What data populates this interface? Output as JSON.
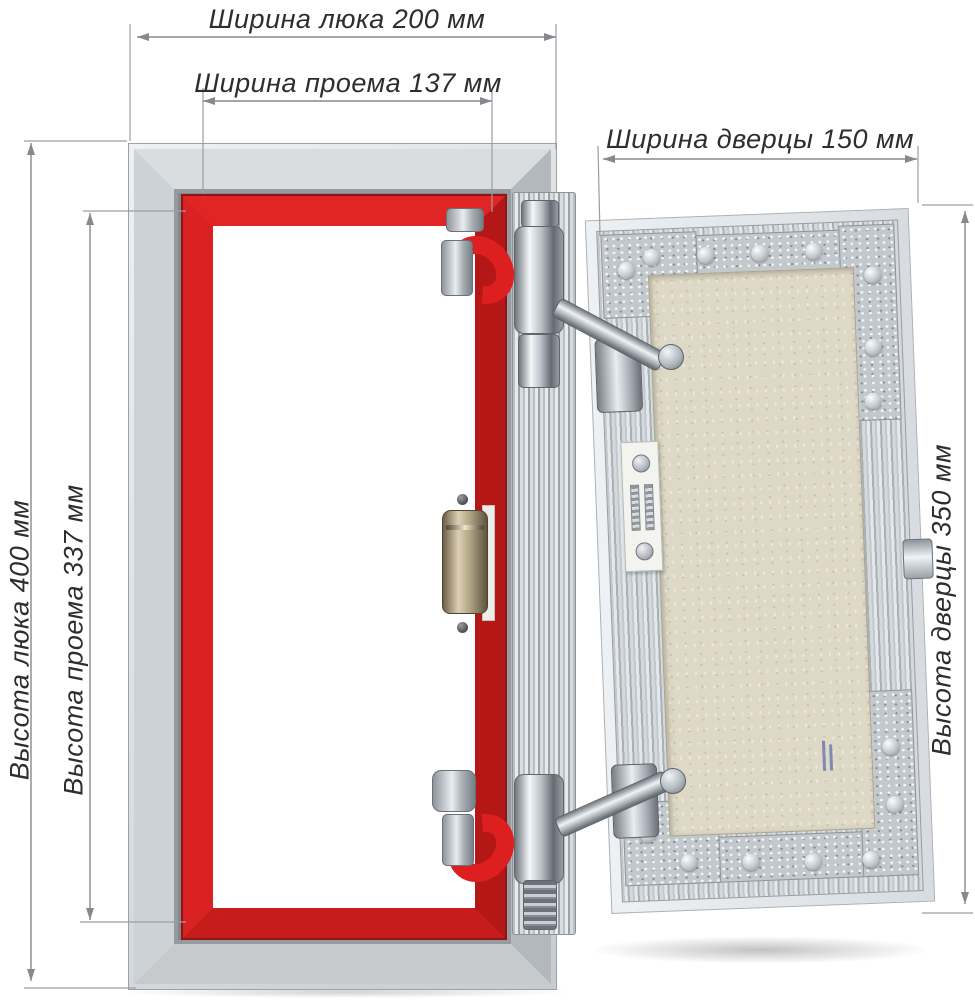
{
  "diagram": {
    "type": "access-hatch-dimension-diagram",
    "unit": "мм",
    "dimensions": {
      "hatch_width": {
        "label": "Ширина люка 200 мм",
        "value_mm": 200
      },
      "opening_width": {
        "label": "Ширина проема 137 мм",
        "value_mm": 137
      },
      "door_width": {
        "label": "Ширина дверцы 150 мм",
        "value_mm": 150
      },
      "hatch_height": {
        "label": "Высота люка 400 мм",
        "value_mm": 400
      },
      "opening_height": {
        "label": "Высота проема 337 мм",
        "value_mm": 337
      },
      "door_height": {
        "label": "Высота дверцы 350 мм",
        "value_mm": 350
      }
    },
    "colors": {
      "background": "#ffffff",
      "frame_red": "#d92121",
      "aluminum": "#c9ced3",
      "panel_beige": "#ded8c6",
      "dimension_line": "#85898d",
      "label_text": "#2e2e2e"
    }
  }
}
